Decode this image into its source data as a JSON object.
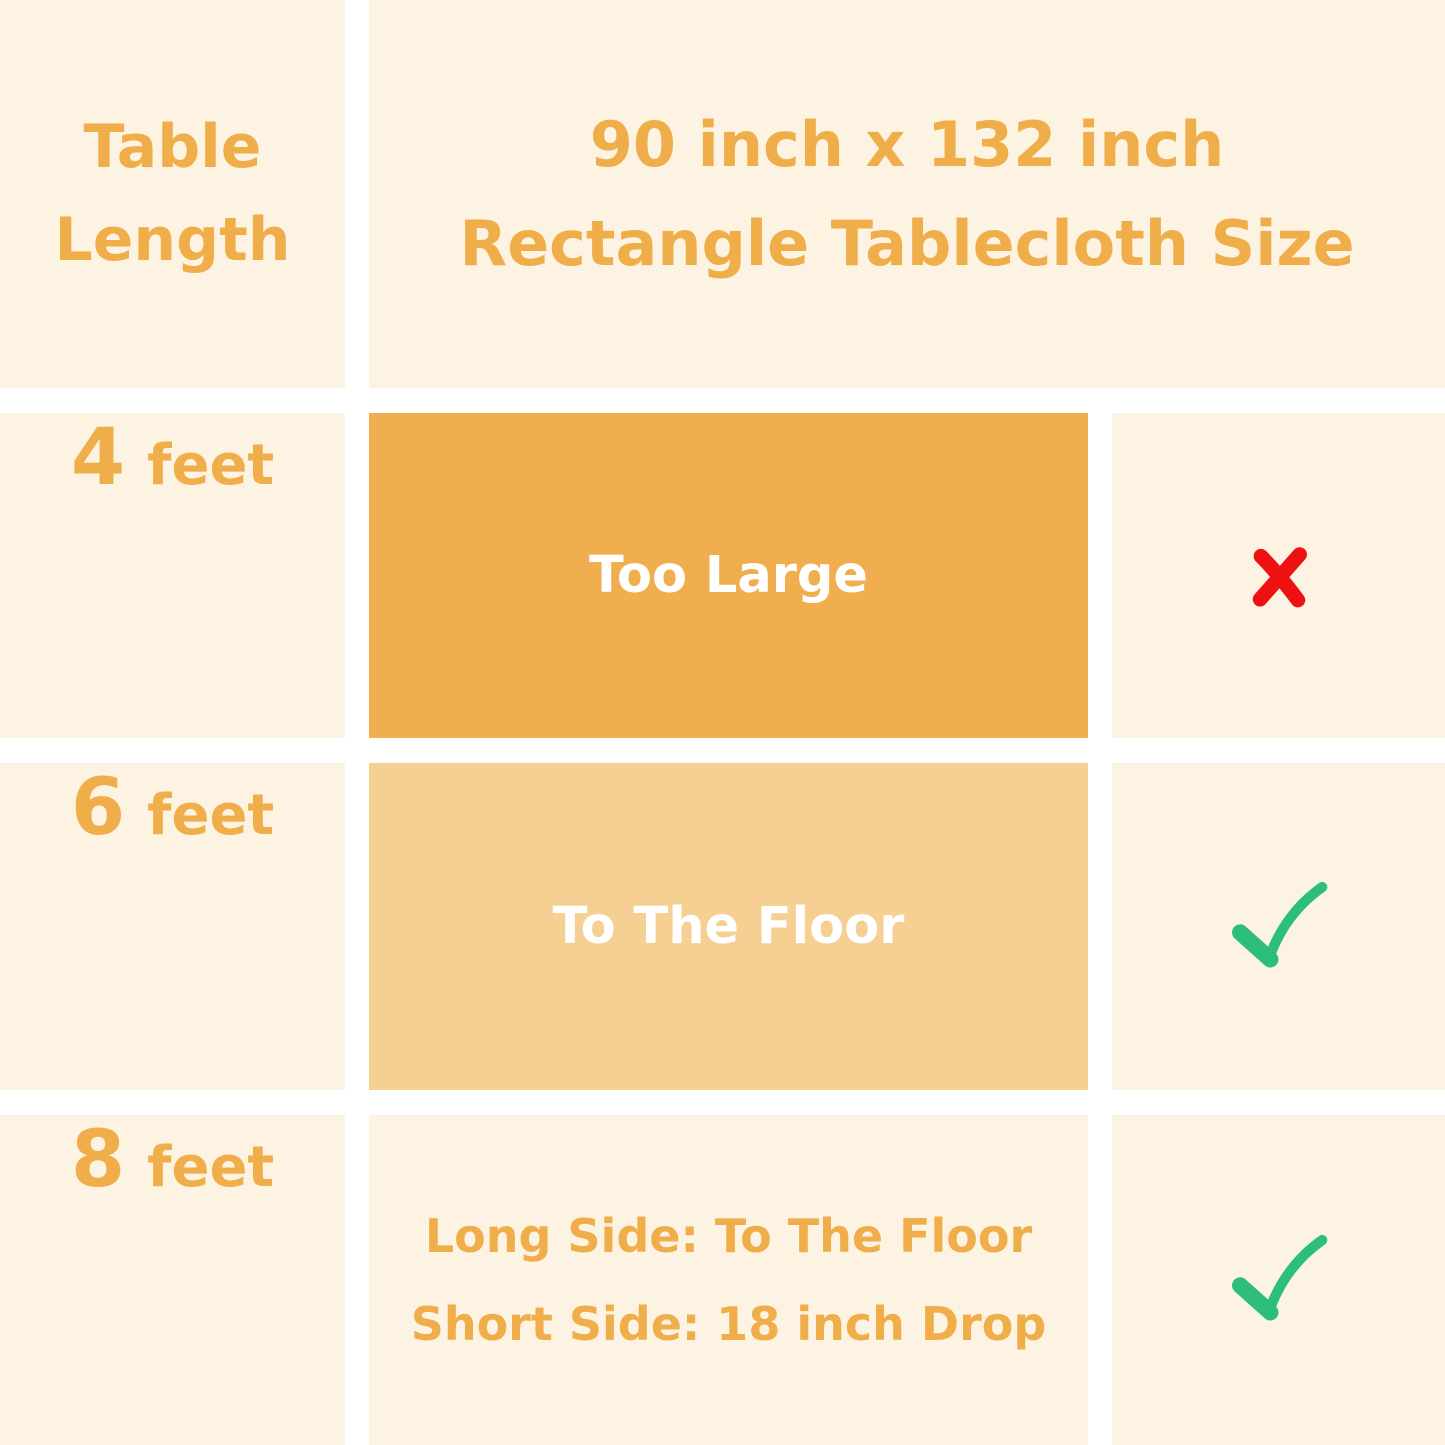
{
  "title": "90 inch x 132 inch Rectangle Tablecloth fit chart",
  "colors": {
    "page_background": "#FFFFFF",
    "cell_background": "#FDF3E3",
    "accent_orange_text": "#F0AE4A",
    "box_dark_orange": "#F0AE4E",
    "box_light_orange": "#F6D093",
    "fit_text_white": "#FFFFFF",
    "cross_red": "#EE1111",
    "check_green": "#2EBE7C"
  },
  "header": {
    "row_label_line1": "Table",
    "row_label_line2": "Length",
    "size_line1": "90 inch x 132 inch",
    "size_line2": "Rectangle Tablecloth Size"
  },
  "rows": [
    {
      "length_number": "4",
      "length_unit": "feet",
      "fit": "Too Large",
      "fit_box": "dark-orange",
      "verdict": "no",
      "verdict_icon": "cross-icon",
      "verdict_glyph": "✗"
    },
    {
      "length_number": "6",
      "length_unit": "feet",
      "fit": "To The Floor",
      "fit_box": "light-orange",
      "verdict": "yes",
      "verdict_icon": "check-icon",
      "verdict_glyph": "✓"
    },
    {
      "length_number": "8",
      "length_unit": "feet",
      "fit_line1": "Long Side: To The Floor",
      "fit_line2": "Short Side: 18 inch Drop",
      "fit_box": "none",
      "verdict": "yes",
      "verdict_icon": "check-icon",
      "verdict_glyph": "✓"
    }
  ]
}
